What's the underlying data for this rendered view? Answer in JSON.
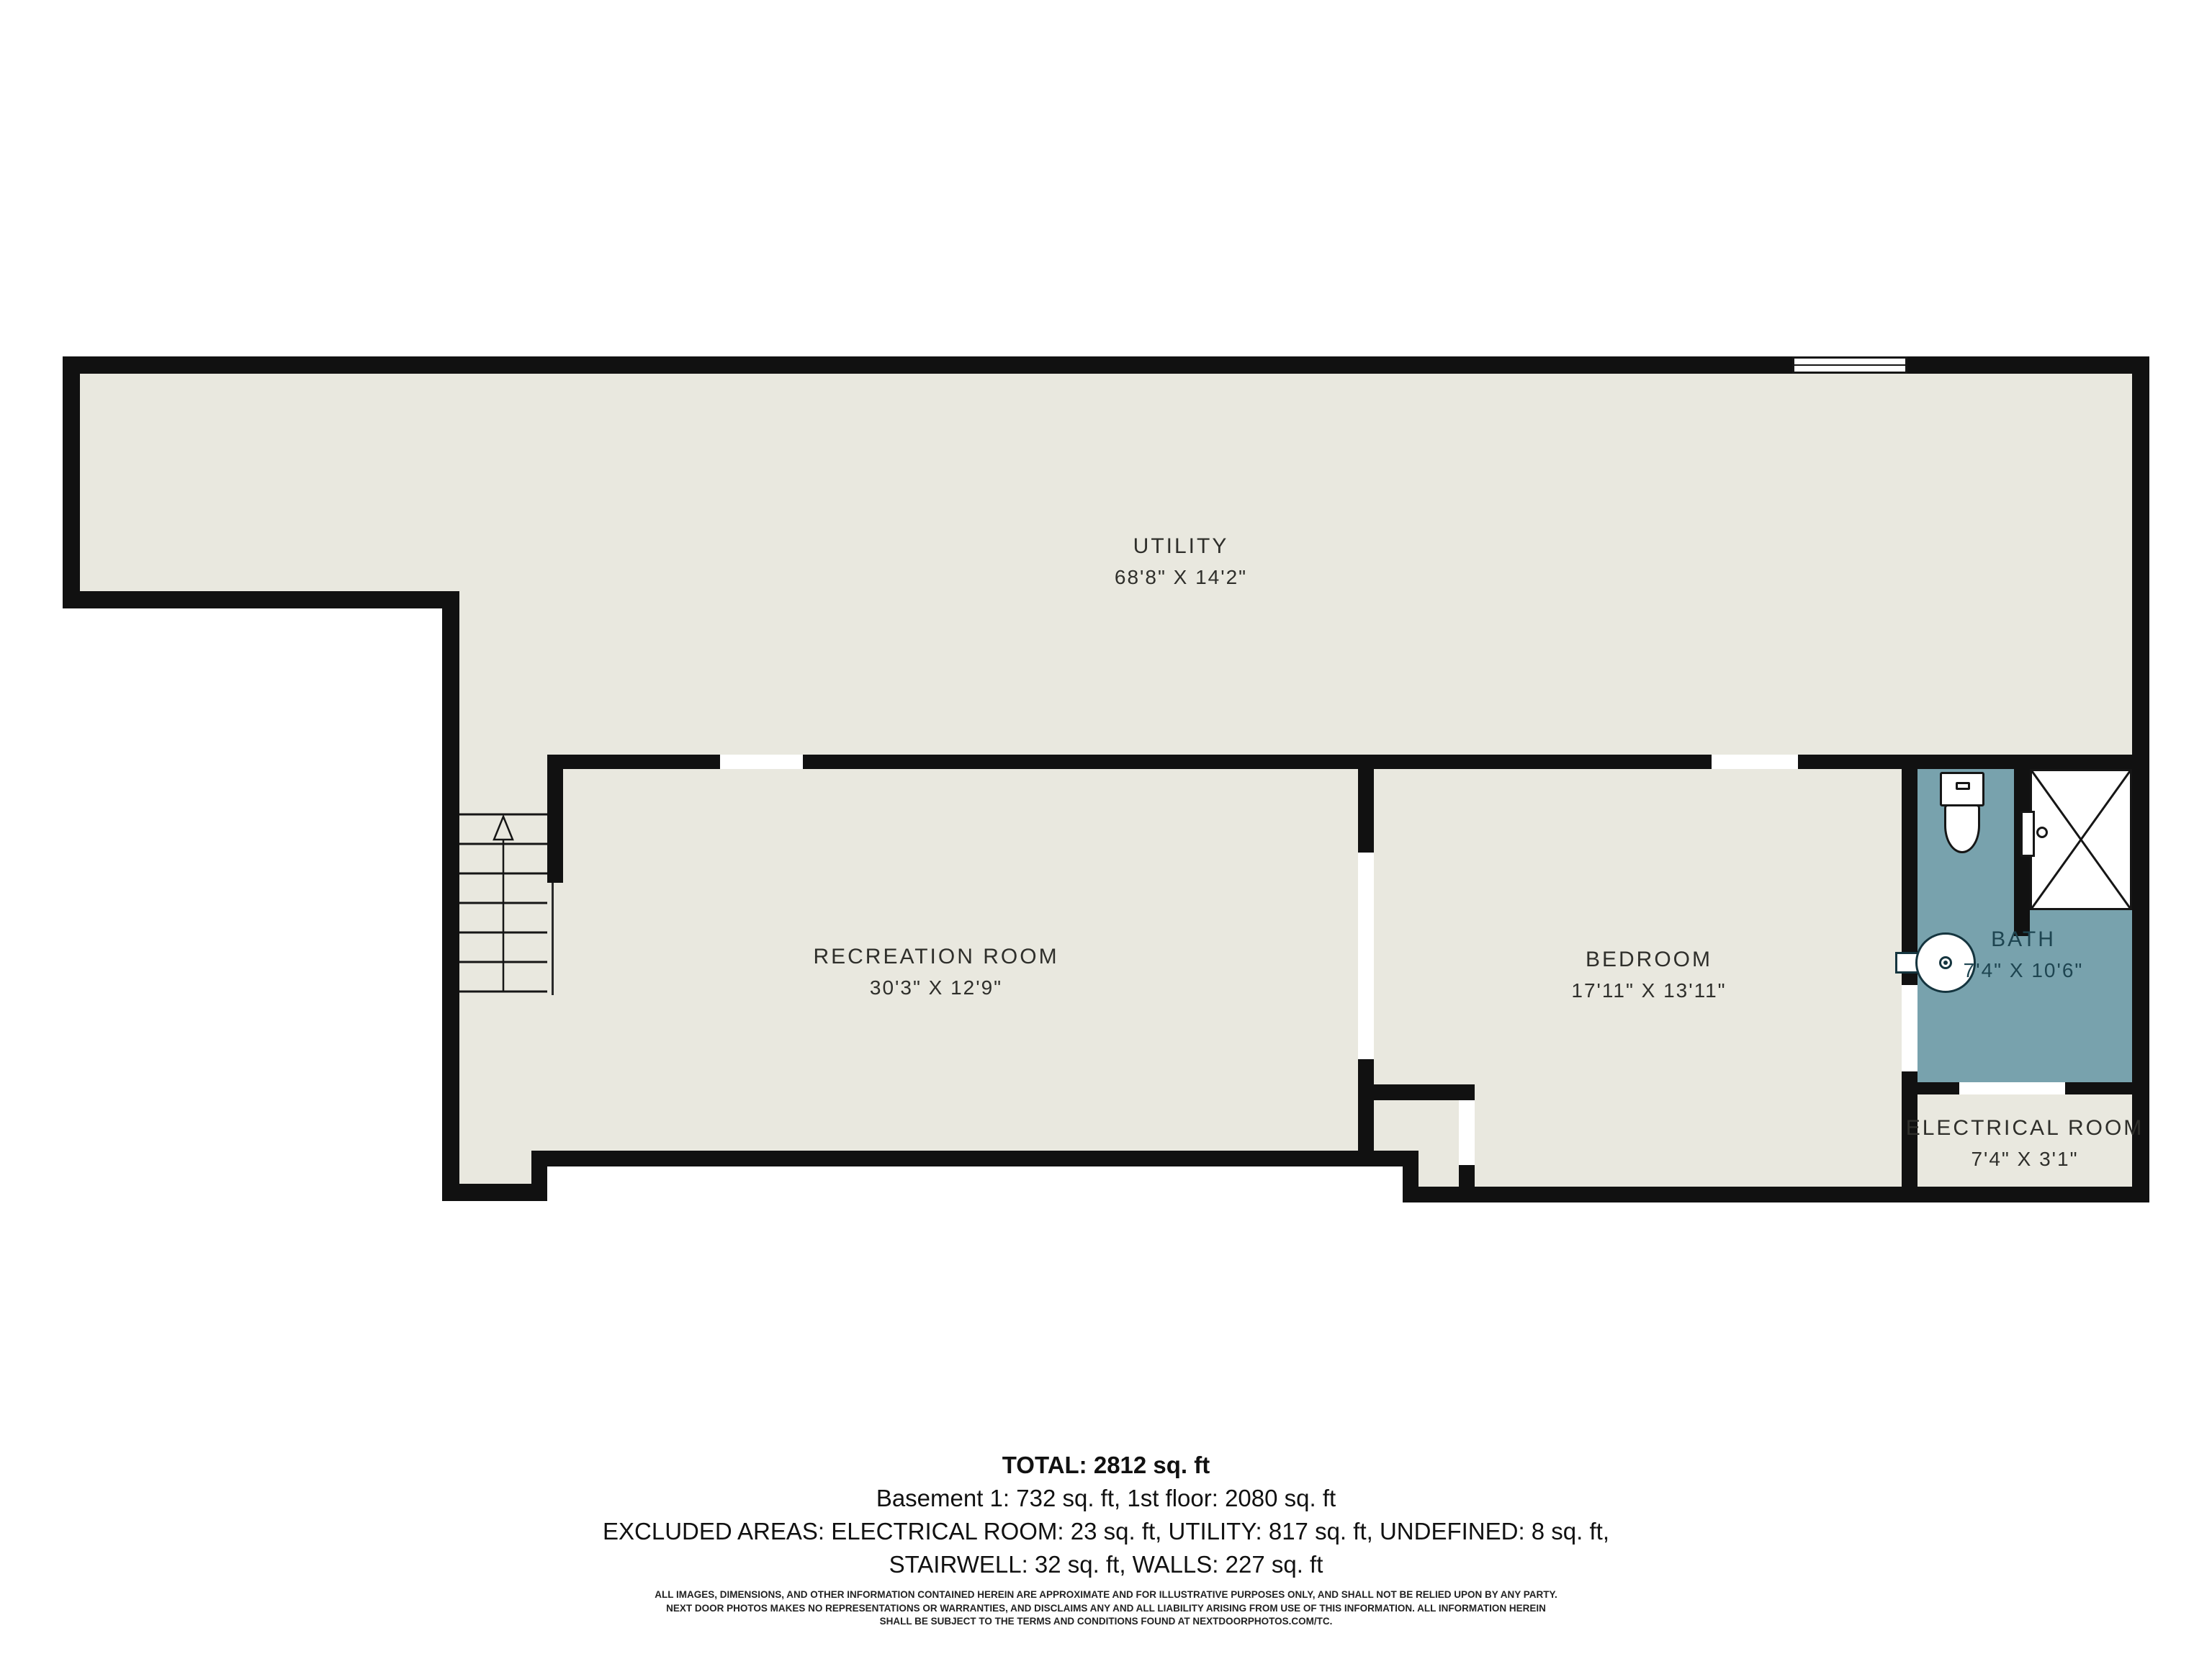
{
  "plan": {
    "type": "floor-plan",
    "floor_name": "Basement",
    "colors": {
      "wall": "#111111",
      "floor": "#e9e8df",
      "bath_floor": "#78a2ad",
      "room_label_text": "#2f2f2b",
      "bath_label_text": "#1e4551",
      "background": "#ffffff"
    },
    "rooms": [
      {
        "id": "utility",
        "name": "UTILITY",
        "dims": "68'8\" X 14'2\""
      },
      {
        "id": "recreation",
        "name": "RECREATION ROOM",
        "dims": "30'3\" X 12'9\""
      },
      {
        "id": "bedroom",
        "name": "BEDROOM",
        "dims": "17'11\" X 13'11\""
      },
      {
        "id": "bath",
        "name": "BATH",
        "dims": "7'4\" X 10'6\""
      },
      {
        "id": "electrical",
        "name": "ELECTRICAL ROOM",
        "dims": "7'4\" X 3'1\""
      }
    ],
    "fixtures": [
      "toilet",
      "shower",
      "sink",
      "stairs",
      "window"
    ]
  },
  "summary": {
    "total": "TOTAL: 2812 sq. ft",
    "floors": "Basement 1: 732 sq. ft, 1st floor: 2080 sq. ft",
    "excluded_1": "EXCLUDED AREAS: ELECTRICAL ROOM: 23 sq. ft, UTILITY: 817 sq. ft, UNDEFINED: 8 sq. ft,",
    "excluded_2": "STAIRWELL: 32 sq. ft, WALLS: 227 sq. ft"
  },
  "disclaimer": {
    "line1": "ALL IMAGES, DIMENSIONS, AND OTHER INFORMATION CONTAINED HEREIN ARE APPROXIMATE AND FOR ILLUSTRATIVE PURPOSES ONLY, AND SHALL NOT BE RELIED UPON BY ANY PARTY.",
    "line2": "NEXT DOOR PHOTOS MAKES NO REPRESENTATIONS OR WARRANTIES, AND DISCLAIMS ANY AND ALL LIABILITY ARISING FROM USE OF THIS INFORMATION. ALL INFORMATION HEREIN",
    "line3": "SHALL BE SUBJECT TO THE TERMS AND CONDITIONS FOUND AT NEXTDOORPHOTOS.COM/TC."
  }
}
